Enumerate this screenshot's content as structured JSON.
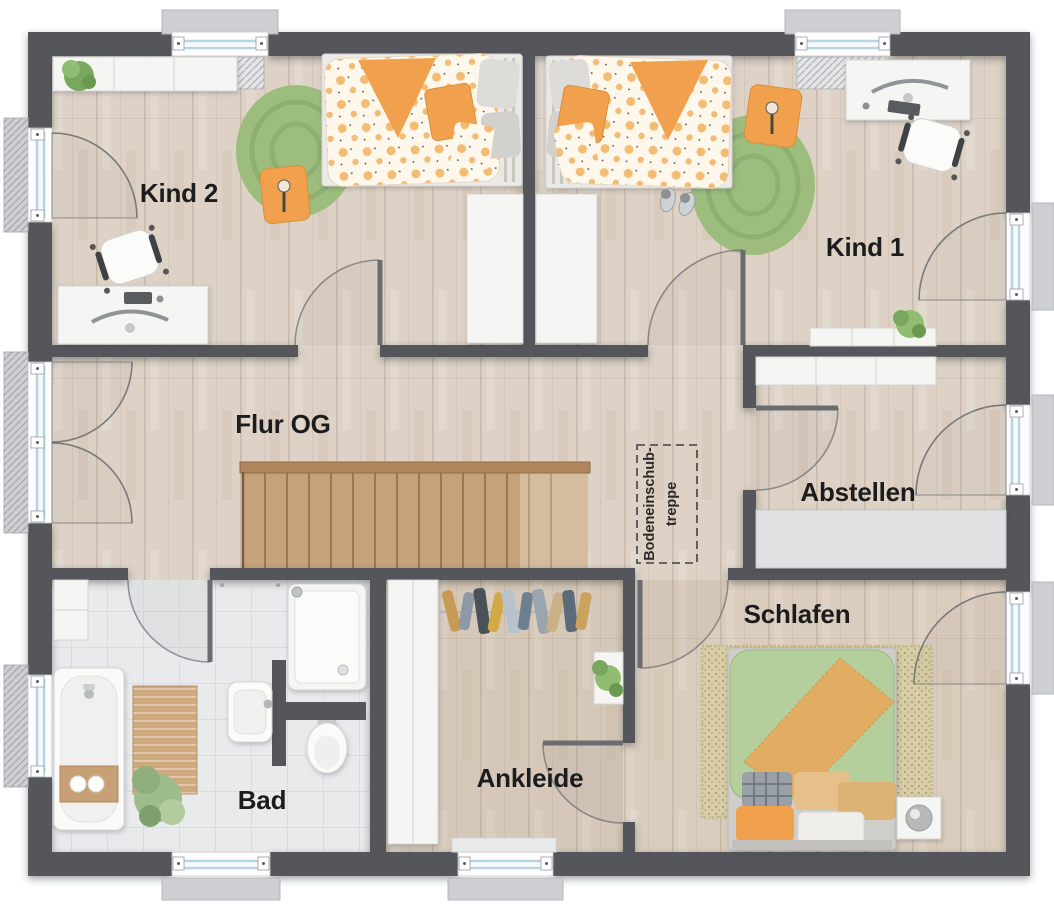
{
  "plan": {
    "rooms": [
      {
        "id": "kind2",
        "label": "Kind 2"
      },
      {
        "id": "kind1",
        "label": "Kind 1"
      },
      {
        "id": "flur-og",
        "label": "Flur OG"
      },
      {
        "id": "abstellen",
        "label": "Abstellen"
      },
      {
        "id": "schlafen",
        "label": "Schlafen"
      },
      {
        "id": "bad",
        "label": "Bad"
      },
      {
        "id": "ankleide",
        "label": "Ankleide"
      }
    ],
    "annotations": [
      {
        "id": "attic-hatch",
        "label_line1": "Bodeneinschub-",
        "label_line2": "treppe"
      }
    ]
  },
  "colors": {
    "wall": "#54565b",
    "floor_wood": "#ddd2c5",
    "floor_tile": "#e8eaec",
    "stair_wood": "#c6a37a",
    "stair_rail": "#b0875c",
    "rug_green": "#9dbd7e",
    "accent_orange": "#f1a14d",
    "duvet_dot_orange": "#f3b666",
    "bed_green": "#b4cf9c",
    "blanket_orange": "#e3ac63",
    "furniture": "#f5f5f3",
    "glass": "#b7d4e4",
    "sill": "#cdcfd2",
    "label_text": "#1c1c1e"
  }
}
